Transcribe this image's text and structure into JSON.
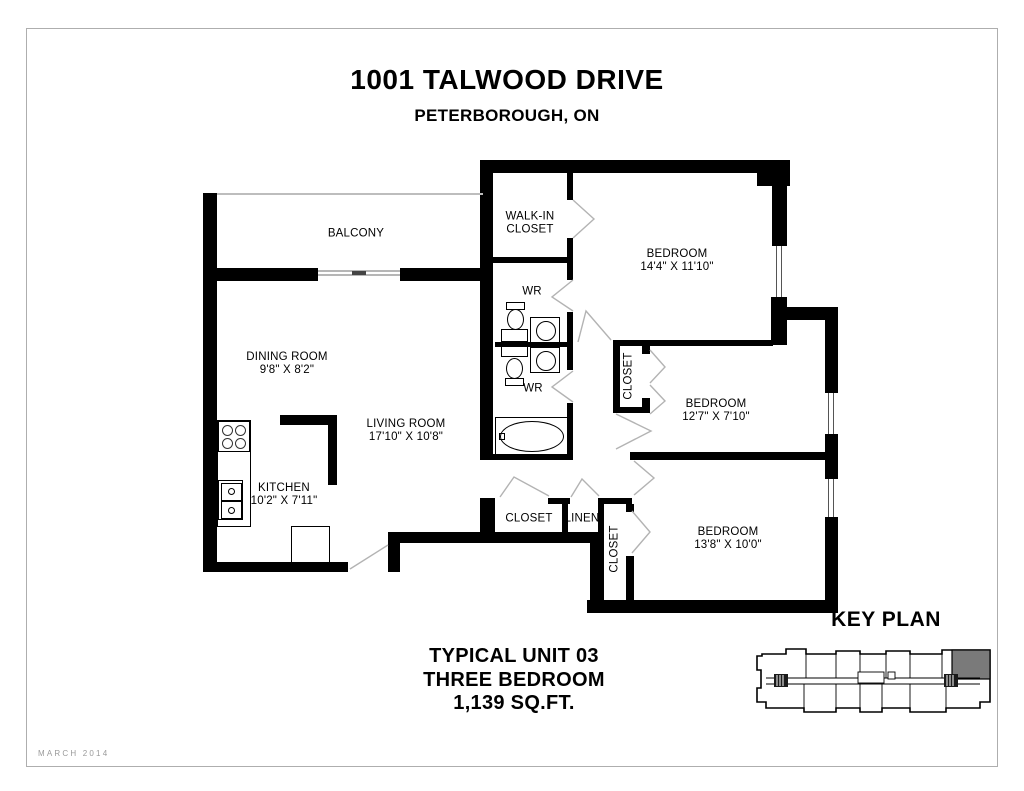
{
  "page": {
    "title_line1": "1001 TALWOOD DRIVE",
    "title_line2": "PETERBOROUGH, ON",
    "footer_line1": "TYPICAL UNIT 03",
    "footer_line2": "THREE BEDROOM",
    "footer_line3": "1,139 SQ.FT.",
    "key_plan_title": "KEY PLAN",
    "date_stamp": "MARCH 2014"
  },
  "rooms": {
    "balcony": {
      "name": "BALCONY"
    },
    "walk_in_closet": {
      "name": "WALK-IN CLOSET"
    },
    "bedroom1": {
      "name": "BEDROOM",
      "dims": "14'4\" X 11'10\""
    },
    "wr1": {
      "name": "WR"
    },
    "wr2": {
      "name": "WR"
    },
    "dining_room": {
      "name": "DINING ROOM",
      "dims": "9'8\" X 8'2\""
    },
    "living_room": {
      "name": "LIVING ROOM",
      "dims": "17'10\" X 10'8\""
    },
    "kitchen": {
      "name": "KITCHEN",
      "dims": "10'2\" X 7'11\""
    },
    "bedroom2": {
      "name": "BEDROOM",
      "dims": "12'7\" X 7'10\""
    },
    "bedroom2_closet": {
      "name": "CLOSET"
    },
    "hall_closet": {
      "name": "CLOSET"
    },
    "linen_closet": {
      "name": "LINEN"
    },
    "bedroom3_closet": {
      "name": "CLOSET"
    },
    "bedroom3": {
      "name": "BEDROOM",
      "dims": "13'8\" X 10'0\""
    }
  },
  "colors": {
    "wall": "#000000",
    "door_swing": "#b3b3b3",
    "railing": "#bdbdbd",
    "key_plan_highlight": "#7a7a7a",
    "date_stamp": "#9a9a9a"
  }
}
